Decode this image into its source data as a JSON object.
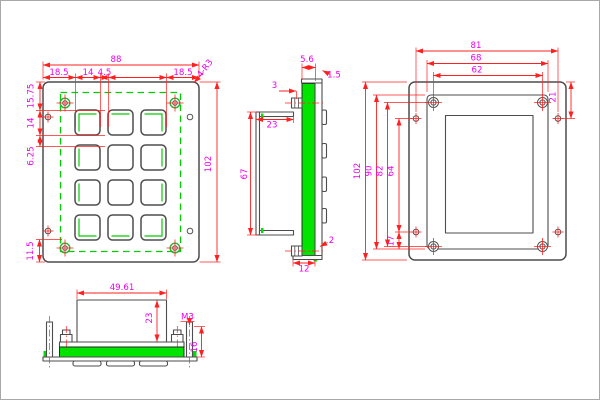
{
  "drawing": {
    "type": "engineering-drawing",
    "subject": "industrial metal keypad panel, 3x4 keys, four orthographic views"
  },
  "colors": {
    "outline": "#4d4d4d",
    "dimension_line": "#ff2020",
    "dimension_text": "#ee00ee",
    "pcb_green": "#00e400",
    "accent_green": "#00cc00",
    "background": "#ffffff",
    "frame_border": "#a8a8a8"
  },
  "views": {
    "front": {
      "label": "front-view",
      "keys": {
        "rows": 4,
        "cols": 3
      },
      "dims": {
        "overall_width": "88",
        "margin_left": "18.5",
        "key_width": "14",
        "key_gap": "4.5",
        "margin_right": "18.5",
        "corner_radius": "4-R3",
        "overall_height": "102",
        "top_offset": "15.75",
        "key_height": "14",
        "row_gap": "6.25",
        "bottom_offset": "11.5"
      }
    },
    "side": {
      "label": "side-view",
      "dims": {
        "stack_thickness": "5.6",
        "panel_thickness": "1.5",
        "screw_offset": "3",
        "cover_depth": "23",
        "cover_height": "67",
        "plate_edge": "2",
        "bottom_flange": "12"
      }
    },
    "back": {
      "label": "back-view",
      "dims": {
        "hole_span_width": "81",
        "cover_width": "68",
        "screw_span_width": "62",
        "corner_offset": "21",
        "overall_height": "102",
        "cover_height": "90",
        "screw_span_height": "82",
        "hole_span_height": "64",
        "hole_offset": "17"
      }
    },
    "bottom": {
      "label": "bottom-section-view",
      "dims": {
        "cover_width": "49.61",
        "cover_depth": "23",
        "stud_thread": "M3",
        "stud_length": "16"
      }
    }
  }
}
